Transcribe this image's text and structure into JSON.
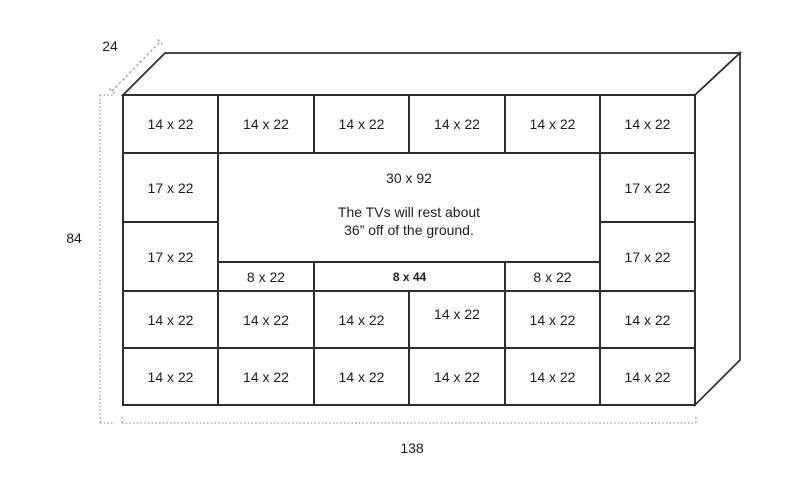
{
  "dimensions": {
    "depth": "24",
    "height": "84",
    "width": "138"
  },
  "center": {
    "size_label": "30 x 92",
    "note_line1": "The TVs will rest about",
    "note_line2": "36” off of the ground."
  },
  "cells": {
    "top_row": [
      "14 x 22",
      "14 x 22",
      "14 x 22",
      "14 x 22",
      "14 x 22",
      "14 x 22"
    ],
    "left_column": [
      "17 x 22",
      "17 x 22"
    ],
    "right_column": [
      "17 x 22",
      "17 x 22"
    ],
    "shelf_row": [
      "8 x 22",
      "8 x 44",
      "8 x 22"
    ],
    "fourth_row": [
      "14 x 22",
      "14 x 22",
      "14 x 22",
      "14 x 22",
      "14 x 22",
      "14 x 22"
    ],
    "bottom_row": [
      "14 x 22",
      "14 x 22",
      "14 x 22",
      "14 x 22",
      "14 x 22",
      "14 x 22"
    ]
  },
  "colors": {
    "line": "#2e2e2e",
    "dimension_line": "#9b9b9b",
    "text": "#1d1d1d",
    "background": "#ffffff"
  }
}
